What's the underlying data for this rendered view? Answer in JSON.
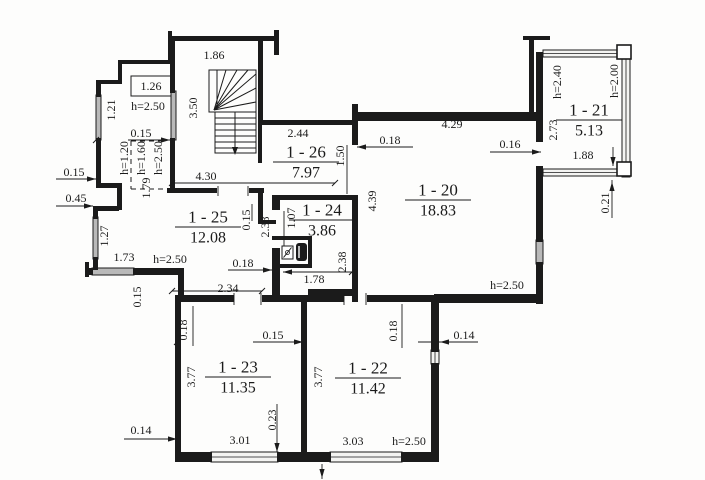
{
  "title": "apartment-floor-plan",
  "canvas": {
    "width": 705,
    "height": 480,
    "background": "#fdfdfc",
    "line_color": "#1b1b1b",
    "window_gray": "#b9b9b9",
    "window_glass": "#f4f4f2"
  },
  "rooms": [
    {
      "number": "1 - 26",
      "area": "7.97",
      "x": 306,
      "y": 152
    },
    {
      "number": "1 - 24",
      "area": "3.86",
      "x": 322,
      "y": 210
    },
    {
      "number": "1 - 25",
      "area": "12.08",
      "x": 208,
      "y": 217
    },
    {
      "number": "1 - 20",
      "area": "18.83",
      "x": 438,
      "y": 190
    },
    {
      "number": "1 - 21",
      "area": "5.13",
      "x": 589,
      "y": 110
    },
    {
      "number": "1 - 23",
      "area": "11.35",
      "x": 238,
      "y": 367
    },
    {
      "number": "1 - 22",
      "area": "11.42",
      "x": 368,
      "y": 368
    }
  ],
  "labels": [
    {
      "t": "1.86",
      "x": 214,
      "y": 55
    },
    {
      "t": "1.26",
      "x": 151,
      "y": 86
    },
    {
      "t": "h=2.50",
      "x": 148,
      "y": 106
    },
    {
      "t": "3.50",
      "x": 193,
      "y": 108,
      "r": 1
    },
    {
      "t": "1.21",
      "x": 111,
      "y": 110,
      "r": 1
    },
    {
      "t": "0.15",
      "x": 141,
      "y": 133
    },
    {
      "t": "h=1.20",
      "x": 124,
      "y": 158,
      "r": 1
    },
    {
      "t": "h=1.60",
      "x": 141,
      "y": 158,
      "r": 1
    },
    {
      "t": "h=2.50",
      "x": 158,
      "y": 158,
      "r": 1
    },
    {
      "t": "1.79",
      "x": 146,
      "y": 188,
      "r": 1
    },
    {
      "t": "0.15",
      "x": 74,
      "y": 172
    },
    {
      "t": "0.45",
      "x": 76,
      "y": 198
    },
    {
      "t": "4.30",
      "x": 206,
      "y": 176
    },
    {
      "t": "1.27",
      "x": 104,
      "y": 236,
      "r": 1
    },
    {
      "t": "1.73",
      "x": 124,
      "y": 257
    },
    {
      "t": "h=2.50",
      "x": 170,
      "y": 259
    },
    {
      "t": "0.15",
      "x": 137,
      "y": 297,
      "r": 1
    },
    {
      "t": "2.44",
      "x": 298,
      "y": 133
    },
    {
      "t": "1.50",
      "x": 340,
      "y": 156,
      "r": 1
    },
    {
      "t": "0.18",
      "x": 390,
      "y": 140
    },
    {
      "t": "4.29",
      "x": 452,
      "y": 124
    },
    {
      "t": "0.16",
      "x": 510,
      "y": 144
    },
    {
      "t": "4.39",
      "x": 372,
      "y": 201,
      "r": 1
    },
    {
      "t": "h=2.40",
      "x": 557,
      "y": 82,
      "r": 1
    },
    {
      "t": "h=2.00",
      "x": 614,
      "y": 81,
      "r": 1
    },
    {
      "t": "2.73",
      "x": 553,
      "y": 130,
      "r": 1
    },
    {
      "t": "1.88",
      "x": 583,
      "y": 155
    },
    {
      "t": "0.21",
      "x": 605,
      "y": 203,
      "r": 1
    },
    {
      "t": "h=2.50",
      "x": 507,
      "y": 285
    },
    {
      "t": "0.15",
      "x": 246,
      "y": 220,
      "r": 1
    },
    {
      "t": "2.38",
      "x": 265,
      "y": 227,
      "r": 1
    },
    {
      "t": "1.07",
      "x": 291,
      "y": 218,
      "r": 1
    },
    {
      "t": "2.38",
      "x": 342,
      "y": 262,
      "r": 1
    },
    {
      "t": "0.18",
      "x": 243,
      "y": 263
    },
    {
      "t": "1.78",
      "x": 314,
      "y": 279
    },
    {
      "t": "2.34",
      "x": 228,
      "y": 288
    },
    {
      "t": "0.18",
      "x": 183,
      "y": 330,
      "r": 1
    },
    {
      "t": "0.15",
      "x": 273,
      "y": 335
    },
    {
      "t": "3.77",
      "x": 191,
      "y": 377,
      "r": 1
    },
    {
      "t": "3.77",
      "x": 318,
      "y": 377,
      "r": 1
    },
    {
      "t": "0.18",
      "x": 393,
      "y": 331,
      "r": 1
    },
    {
      "t": "0.14",
      "x": 464,
      "y": 335
    },
    {
      "t": "0.23",
      "x": 272,
      "y": 420,
      "r": 1
    },
    {
      "t": "0.14",
      "x": 141,
      "y": 430
    },
    {
      "t": "3.01",
      "x": 240,
      "y": 440
    },
    {
      "t": "3.03",
      "x": 353,
      "y": 441
    },
    {
      "t": "h=2.50",
      "x": 409,
      "y": 441
    }
  ],
  "walls": [
    [
      168,
      31,
      4,
      30
    ],
    [
      170,
      36,
      108,
      5
    ],
    [
      274,
      30,
      5,
      25
    ],
    [
      258,
      39,
      5,
      86
    ],
    [
      258,
      120,
      100,
      5
    ],
    [
      170,
      40,
      5,
      53
    ],
    [
      170,
      138,
      5,
      52
    ],
    [
      258,
      125,
      4,
      38
    ],
    [
      118,
      60,
      54,
      4
    ],
    [
      118,
      60,
      4,
      24
    ],
    [
      96,
      80,
      26,
      4
    ],
    [
      96,
      82,
      5,
      15
    ],
    [
      96,
      138,
      5,
      48
    ],
    [
      96,
      183,
      26,
      5
    ],
    [
      117,
      183,
      5,
      27
    ],
    [
      93,
      206,
      26,
      5
    ],
    [
      93,
      209,
      5,
      10
    ],
    [
      93,
      257,
      5,
      13
    ],
    [
      85,
      262,
      4,
      15
    ],
    [
      85,
      268,
      8,
      7
    ],
    [
      133,
      268,
      50,
      7
    ],
    [
      178,
      268,
      6,
      32
    ],
    [
      175,
      296,
      6,
      160
    ],
    [
      167,
      188,
      50,
      5
    ],
    [
      249,
      188,
      15,
      5
    ],
    [
      258,
      188,
      5,
      36
    ],
    [
      258,
      220,
      18,
      4
    ],
    [
      272,
      195,
      8,
      15
    ],
    [
      272,
      248,
      8,
      54
    ],
    [
      272,
      195,
      84,
      5
    ],
    [
      272,
      236,
      40,
      4
    ],
    [
      272,
      264,
      40,
      4
    ],
    [
      308,
      236,
      4,
      30
    ],
    [
      308,
      289,
      48,
      7
    ],
    [
      352,
      104,
      6,
      41
    ],
    [
      352,
      195,
      6,
      107
    ],
    [
      352,
      112,
      184,
      9
    ],
    [
      523,
      36,
      27,
      4
    ],
    [
      529,
      36,
      5,
      80
    ],
    [
      536,
      52,
      7,
      90
    ],
    [
      536,
      166,
      7,
      76
    ],
    [
      536,
      262,
      7,
      42
    ],
    [
      434,
      294,
      106,
      9
    ],
    [
      367,
      295,
      68,
      7
    ],
    [
      262,
      295,
      82,
      7
    ],
    [
      175,
      295,
      59,
      7
    ],
    [
      431,
      295,
      8,
      57
    ],
    [
      431,
      363,
      8,
      99
    ],
    [
      301,
      302,
      6,
      152
    ],
    [
      175,
      452,
      37,
      10
    ],
    [
      277,
      452,
      54,
      10
    ],
    [
      401,
      452,
      38,
      10
    ]
  ],
  "windows": [
    {
      "k": "g",
      "x": 96,
      "y": 95,
      "w": 5,
      "h": 45
    },
    {
      "k": "g",
      "x": 171,
      "y": 91,
      "w": 5,
      "h": 49
    },
    {
      "k": "g",
      "x": 93,
      "y": 217,
      "w": 5,
      "h": 42
    },
    {
      "k": "g",
      "x": 92,
      "y": 268,
      "w": 42,
      "h": 7
    },
    {
      "k": "g",
      "x": 536,
      "y": 240,
      "w": 7,
      "h": 24
    },
    {
      "k": "w",
      "x": 543,
      "y": 50,
      "w": 80,
      "h": 7,
      "o": "h"
    },
    {
      "k": "w",
      "x": 622,
      "y": 50,
      "w": 8,
      "h": 127,
      "o": "v"
    },
    {
      "k": "w",
      "x": 543,
      "y": 169,
      "w": 78,
      "h": 7,
      "o": "h"
    },
    {
      "k": "w",
      "x": 431,
      "y": 350,
      "w": 8,
      "h": 14,
      "o": "v"
    },
    {
      "k": "w",
      "x": 211,
      "y": 452,
      "w": 67,
      "h": 10,
      "o": "h"
    },
    {
      "k": "w",
      "x": 330,
      "y": 452,
      "w": 72,
      "h": 10,
      "o": "h"
    }
  ],
  "posts": [
    [
      617,
      45,
      14,
      14
    ],
    [
      617,
      162,
      14,
      14
    ]
  ],
  "dashes": [
    [
      131,
      141,
      164,
      141
    ],
    [
      131,
      141,
      131,
      189
    ],
    [
      131,
      189,
      164,
      189
    ]
  ],
  "dim_lines": [
    [
      128,
      140,
      172,
      140
    ],
    [
      56,
      179,
      96,
      179
    ],
    [
      56,
      206,
      93,
      206
    ],
    [
      172,
      183,
      335,
      183
    ],
    [
      357,
      147,
      413,
      147
    ],
    [
      490,
      152,
      541,
      152
    ],
    [
      228,
      270,
      272,
      270
    ],
    [
      283,
      272,
      352,
      272
    ],
    [
      172,
      291,
      262,
      291
    ],
    [
      253,
      342,
      303,
      342
    ],
    [
      418,
      342,
      478,
      342
    ],
    [
      124,
      439,
      177,
      439
    ],
    [
      277,
      404,
      277,
      452
    ],
    [
      612,
      180,
      612,
      218
    ],
    [
      193,
      306,
      193,
      346
    ],
    [
      402,
      304,
      402,
      348
    ],
    [
      613,
      147,
      613,
      166
    ],
    [
      322,
      464,
      322,
      479
    ],
    [
      252,
      204,
      252,
      221
    ],
    [
      347,
      145,
      347,
      194
    ],
    [
      284,
      211,
      284,
      247
    ],
    [
      234,
      293,
      234,
      305
    ],
    [
      261,
      293,
      261,
      305
    ],
    [
      344,
      293,
      344,
      305
    ],
    [
      366,
      293,
      366,
      305
    ],
    [
      218,
      186,
      218,
      196
    ],
    [
      248,
      186,
      248,
      196
    ]
  ],
  "ticks": [
    [
      172,
      183
    ],
    [
      335,
      183
    ],
    [
      172,
      291
    ],
    [
      262,
      291
    ],
    [
      352,
      272
    ],
    [
      96,
      140
    ],
    [
      177,
      342
    ]
  ],
  "arrows": [
    {
      "x": 170,
      "y": 140,
      "d": "r"
    },
    {
      "x": 96,
      "y": 179,
      "d": "r"
    },
    {
      "x": 93,
      "y": 206,
      "d": "r"
    },
    {
      "x": 357,
      "y": 147,
      "d": "l"
    },
    {
      "x": 541,
      "y": 152,
      "d": "r"
    },
    {
      "x": 272,
      "y": 270,
      "d": "r"
    },
    {
      "x": 283,
      "y": 272,
      "d": "l"
    },
    {
      "x": 303,
      "y": 342,
      "d": "r"
    },
    {
      "x": 440,
      "y": 342,
      "d": "l"
    },
    {
      "x": 177,
      "y": 439,
      "d": "r"
    },
    {
      "x": 277,
      "y": 452,
      "d": "d"
    },
    {
      "x": 612,
      "y": 182,
      "d": "u"
    },
    {
      "x": 613,
      "y": 166,
      "d": "d"
    },
    {
      "x": 322,
      "y": 478,
      "d": "d"
    }
  ],
  "closet_box": [
    131,
    76,
    40,
    20
  ],
  "stair": {
    "upper": [
      209,
      70,
      47,
      42
    ],
    "lower": [
      215,
      112,
      41,
      41
    ],
    "pivot": [
      214,
      110
    ],
    "ray_ends": [
      [
        226,
        70
      ],
      [
        237,
        70
      ],
      [
        248,
        70
      ],
      [
        256,
        74
      ],
      [
        256,
        88
      ],
      [
        256,
        102
      ]
    ],
    "divider": [
      217,
      70,
      217,
      110
    ],
    "tread_ys": [
      118,
      124,
      130,
      136,
      142,
      148
    ],
    "tread_x": [
      215,
      256
    ],
    "arrow": [
      235,
      112,
      235,
      149
    ]
  },
  "fixtures": {
    "basin": {
      "x": 282,
      "y": 246,
      "w": 11,
      "h": 13
    },
    "heater": {
      "x": 296,
      "y": 243,
      "w": 11,
      "h": 18
    }
  }
}
